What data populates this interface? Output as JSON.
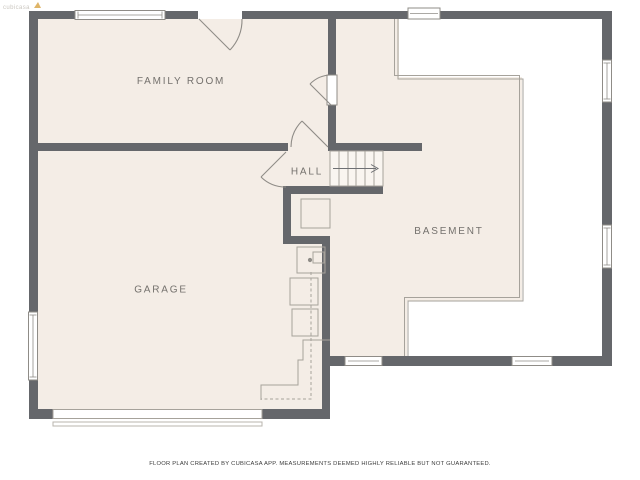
{
  "watermark": {
    "text": "cubicasa"
  },
  "rooms": [
    {
      "id": "family-room",
      "label": "FAMILY ROOM"
    },
    {
      "id": "hall",
      "label": "HALL"
    },
    {
      "id": "basement",
      "label": "BASEMENT"
    },
    {
      "id": "garage",
      "label": "GARAGE"
    }
  ],
  "icons": {
    "stairs_direction": "right-arrow",
    "water_heater": "circle-dot-fixture"
  },
  "footer": {
    "disclaimer": "FLOOR PLAN CREATED BY CUBICASA APP. MEASUREMENTS DEEMED HIGHLY RELIABLE BUT NOT GUARANTEED."
  },
  "colors": {
    "wall": "#65676b",
    "floor": "#f4ede6",
    "background": "#ffffff",
    "thin_line": "#a6a29b",
    "door_line": "#8f8c87",
    "room_label": "#74716d",
    "footer_text": "#3c3c3c",
    "watermark_gold": "#d9a84e"
  }
}
